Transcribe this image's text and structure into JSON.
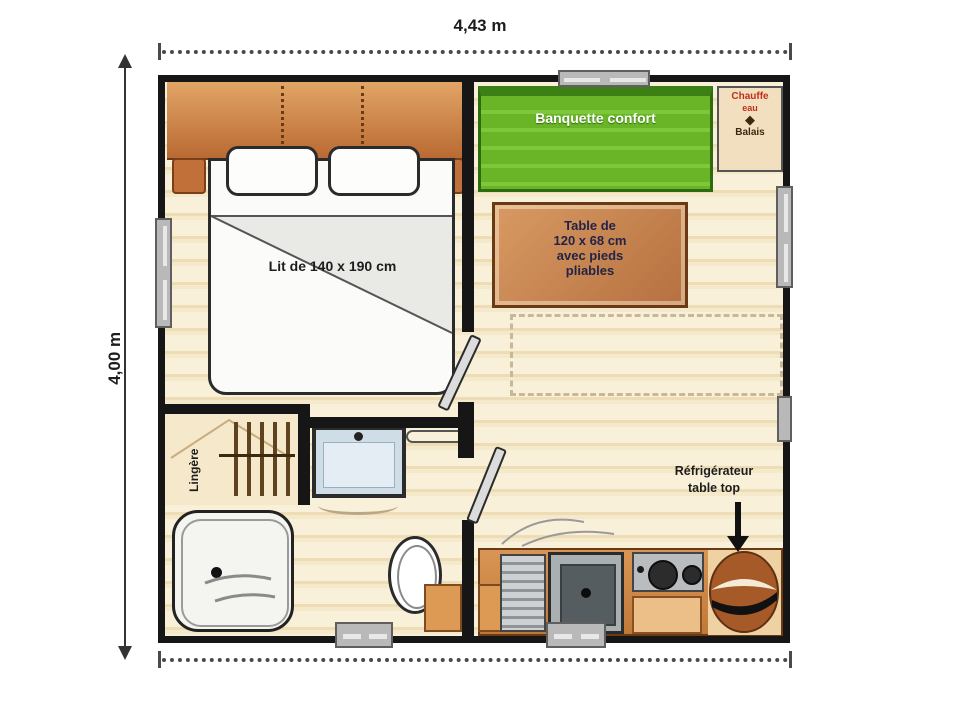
{
  "dimensions": {
    "width_label": "4,43 m",
    "height_label": "4,00 m"
  },
  "bedroom": {
    "bed_label": "Lit de 140 x 190 cm",
    "wardrobe_label": "Lingère"
  },
  "living": {
    "banquette_label": "Banquette confort",
    "table_label": {
      "l1": "Table de",
      "l2": "120 x 68 cm",
      "l3": "avec pieds",
      "l4": "pliables"
    },
    "utility_closet": {
      "l1": "Chauffe",
      "l2": "eau",
      "l3": "Balais"
    }
  },
  "kitchen": {
    "fridge_label": {
      "l1": "Réfrigérateur",
      "l2": "table top"
    }
  },
  "colors": {
    "wall": "#161616",
    "floor": "#f6ead0",
    "banquette_green": "#62b32a",
    "wood_orange": "#c9803f",
    "table_text": "#232346",
    "closet_red": "#c03018",
    "window_grey": "#b9b9b9"
  }
}
